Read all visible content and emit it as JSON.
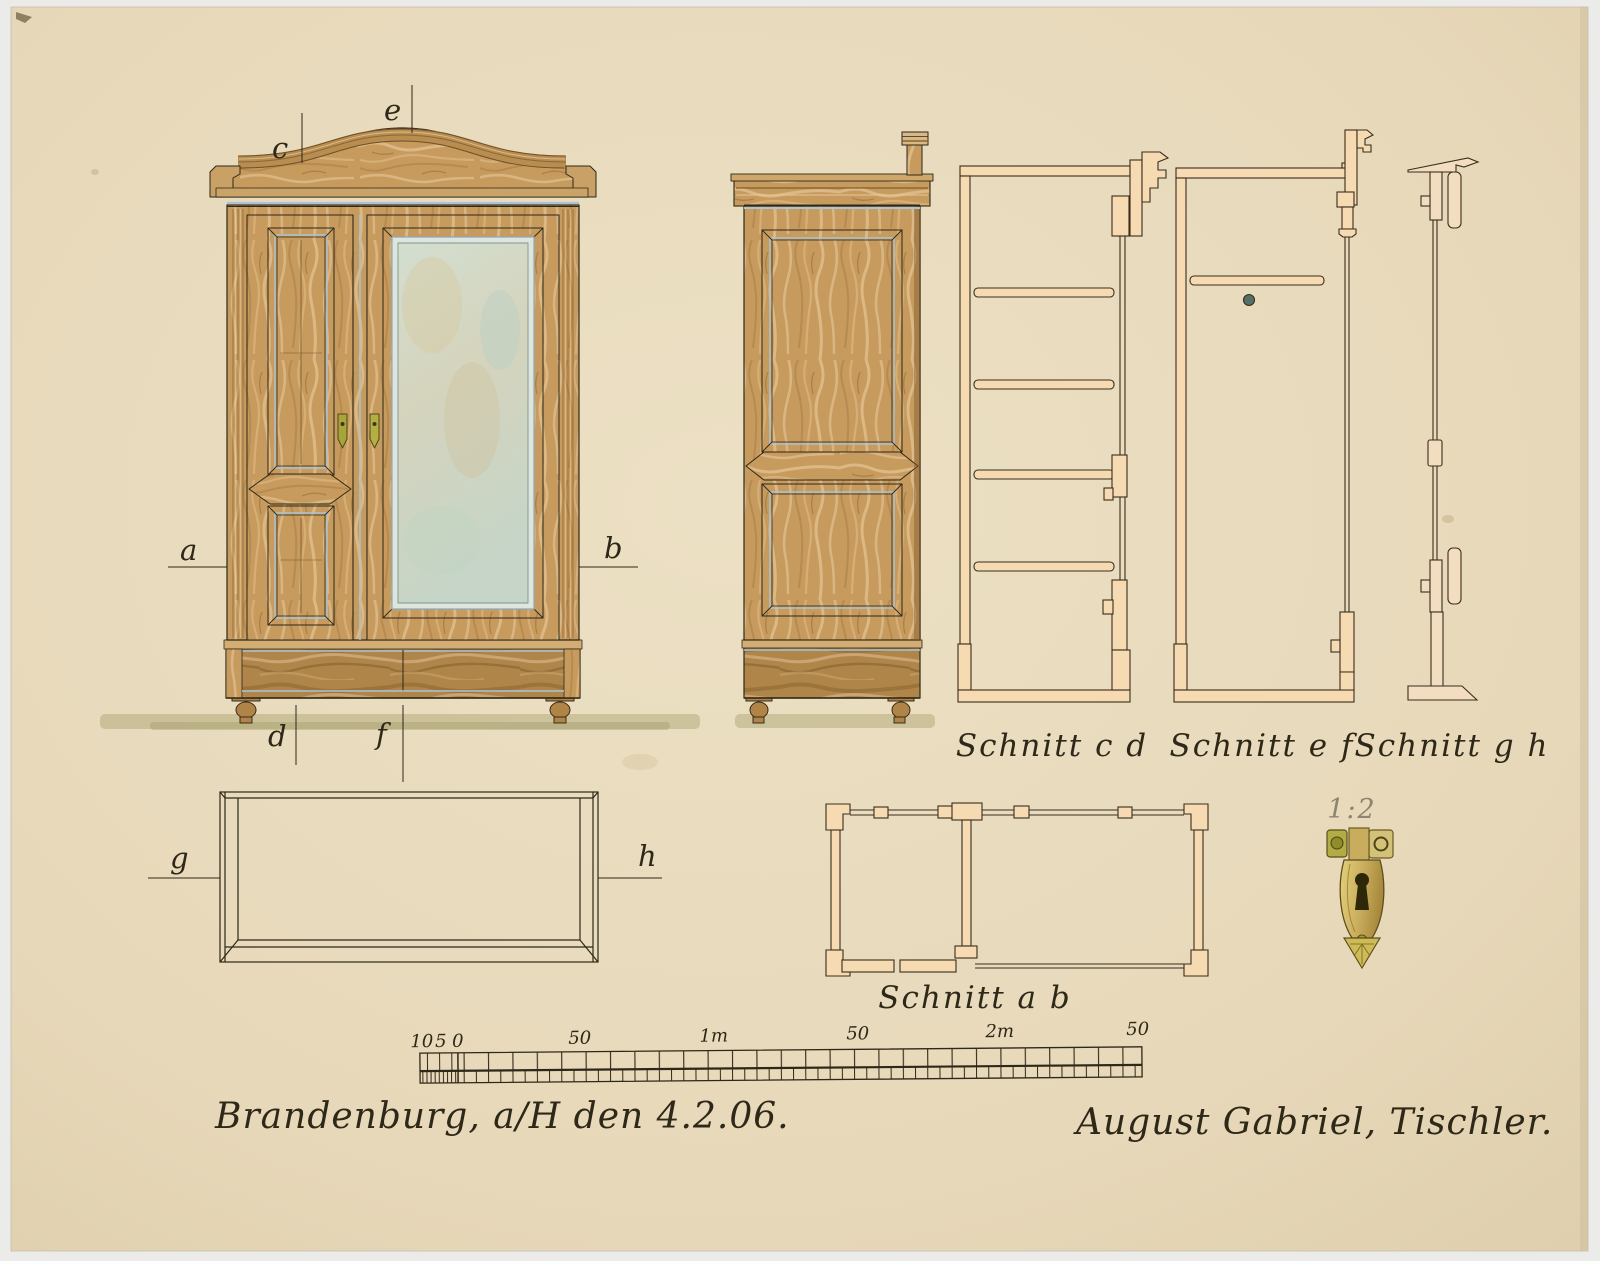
{
  "markers": {
    "a": "a",
    "b": "b",
    "c": "c",
    "d": "d",
    "e": "e",
    "f": "f",
    "g": "g",
    "h": "h"
  },
  "section_labels": {
    "cd": "Schnitt c d",
    "ef": "Schnitt e f",
    "gh": "Schnitt g h",
    "ab": "Schnitt a b"
  },
  "detail_scale_label": "1:2",
  "scale_bar": {
    "tick_labels": [
      "10",
      "5",
      "0",
      "50",
      "1m",
      "50",
      "2m",
      "50"
    ]
  },
  "inscriptions": {
    "place_date": "Brandenburg, a/H den 4.2.06.",
    "signature": "August Gabriel, Tischler."
  },
  "colors": {
    "paper": "#e7d8b9",
    "ink": "#2e2818",
    "wood": "#c79a5e",
    "wood_dark": "#8a6530",
    "wood_base": "#b0854a",
    "mirror": "#ccd8ca",
    "section_fill": "#f5dab2",
    "brass": "#c9ad5e",
    "shadow_olive": "#b3ab7c",
    "accent_blue": "#aac4d6",
    "pencil": "#8d8570"
  }
}
